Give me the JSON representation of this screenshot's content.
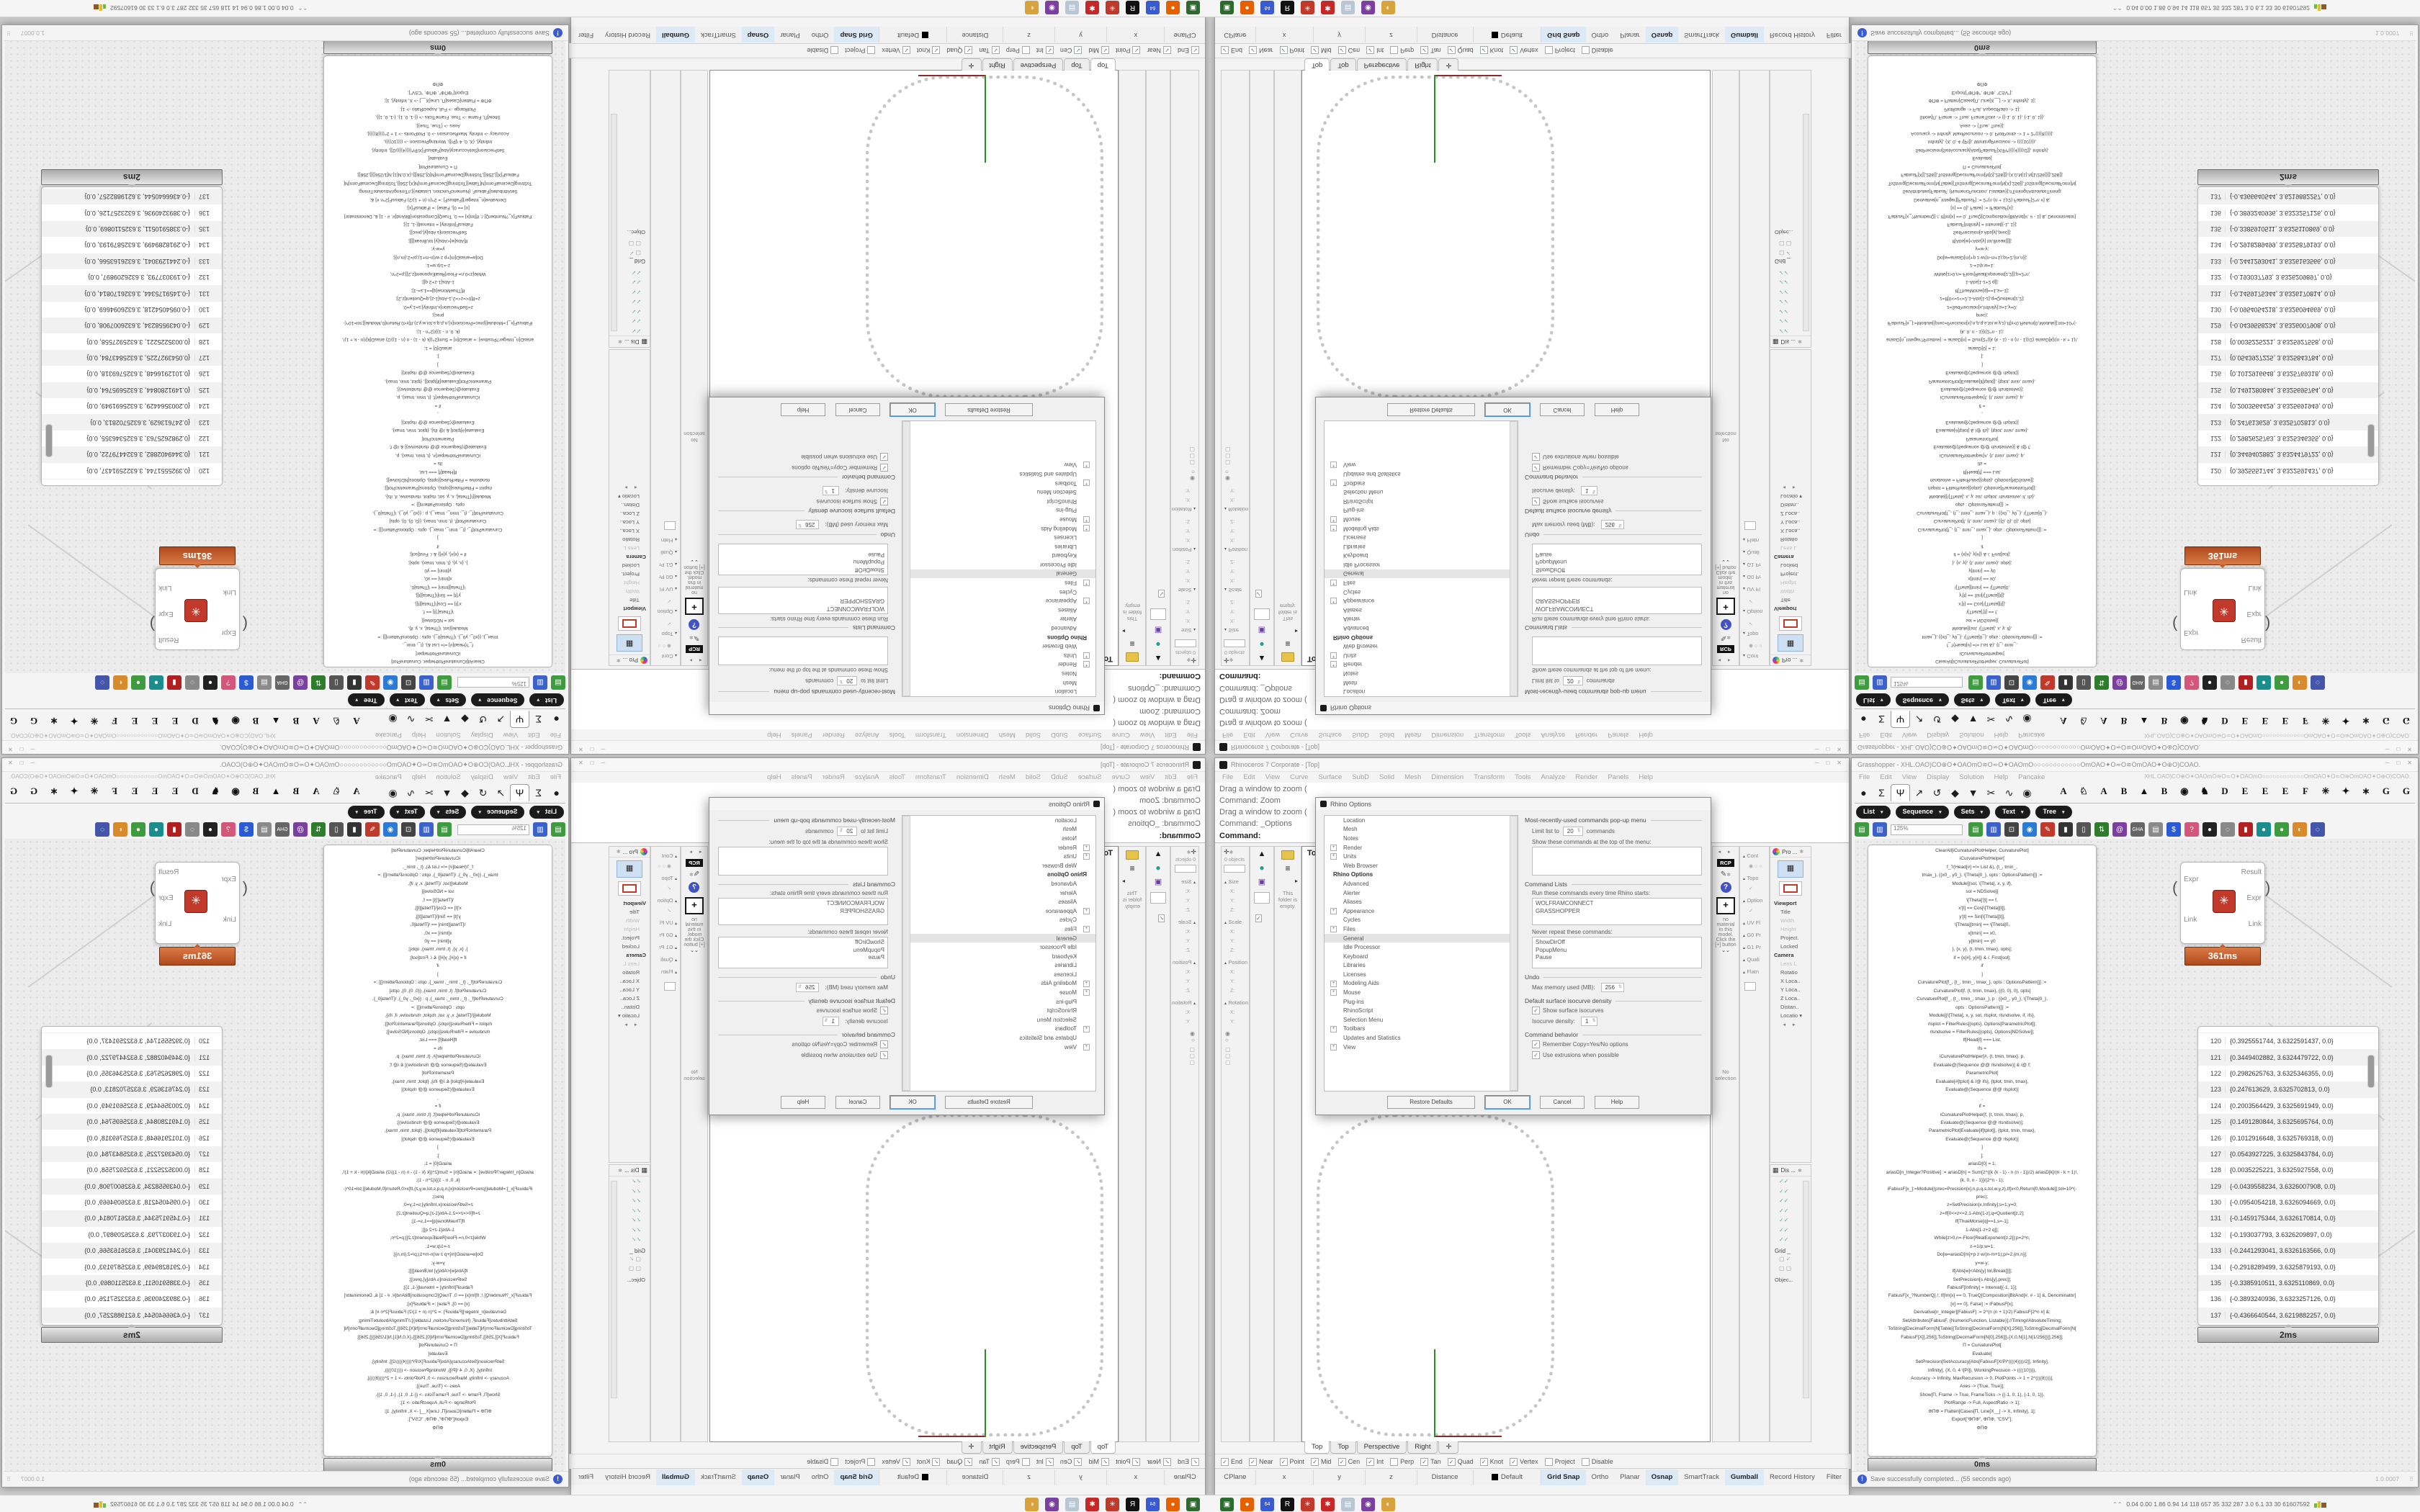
{
  "rhino": {
    "title": "Rhinoceros 7 Corporate - [Top]",
    "window_controls": [
      "─",
      "□",
      "✕"
    ],
    "menu": [
      "File",
      "Edit",
      "View",
      "Curve",
      "Surface",
      "SubD",
      "Solid",
      "Mesh",
      "Dimension",
      "Transform",
      "Tools",
      "Analyze",
      "Render",
      "Panels",
      "Help"
    ],
    "command_history": [
      "Drag a window to zoom (",
      "Command: Zoom",
      "Drag a window to zoom (",
      "Command: _Options"
    ],
    "command_prompt": "Command:",
    "viewport": {
      "label": "Top",
      "tabs": [
        {
          "label": "Top",
          "active": true
        },
        {
          "label": "Top"
        },
        {
          "label": "Perspective"
        },
        {
          "label": "Right"
        },
        {
          "label": "✛"
        }
      ]
    },
    "left_panels": {
      "boxedit_objects": "0 objects",
      "boxedit_groups": [
        {
          "t": "Size"
        },
        {
          "t": "X:",
          "cls": "ax"
        },
        {
          "t": "Y:",
          "cls": "ax"
        },
        {
          "t": "Z:",
          "cls": "ax"
        },
        {
          "t": "Scale"
        },
        {
          "t": "X:",
          "cls": "ax"
        },
        {
          "t": "Y:",
          "cls": "ax"
        },
        {
          "t": "Z:",
          "cls": "ax"
        },
        {
          "t": "Position"
        },
        {
          "t": "X:",
          "cls": "ax"
        },
        {
          "t": "Y:",
          "cls": "ax"
        },
        {
          "t": "Z:",
          "cls": "ax"
        },
        {
          "t": "Rotation"
        },
        {
          "t": "X:",
          "cls": "ax"
        },
        {
          "t": "Y:",
          "cls": "ax"
        }
      ],
      "folder_note": "This folder is empty."
    },
    "right_panels": {
      "materials": {
        "tab": "RCP",
        "plus": "+",
        "empty_text": "no material in this model. Click the [+] button",
        "chevrons": "⌄⌄",
        "selection": "No selection"
      },
      "analysis_labels": [
        {
          "t": "Cont"
        },
        {
          "t": "◉ ○ ○",
          "cls": "ax"
        },
        {
          "t": "Topo"
        },
        {
          "t": "✓",
          "cls": "ax"
        },
        {
          "t": "Option"
        },
        {
          "t": "✓",
          "cls": "ax"
        },
        {
          "t": "UV Fl"
        },
        {
          "t": "G0 Pr"
        },
        {
          "t": "G1 Pr"
        },
        {
          "t": "Quali"
        },
        {
          "t": "Flatn"
        }
      ],
      "properties": {
        "header": "Pro ...",
        "rows": [
          {
            "t": "Viewport",
            "cls": "b"
          },
          {
            "t": "Title"
          },
          {
            "t": "Width",
            "cls": "dim"
          },
          {
            "t": "Height",
            "cls": "dim"
          },
          {
            "t": "Project."
          },
          {
            "t": "Locked"
          },
          {
            "t": "Camera",
            "cls": "b"
          },
          {
            "t": "Lens L",
            "cls": "dim"
          },
          {
            "t": "Rotatio"
          },
          {
            "t": "X Loca.."
          },
          {
            "t": "Y Loca.."
          },
          {
            "t": "Z Loca.."
          },
          {
            "t": "Distan.."
          },
          {
            "t": "Locatio ▾"
          }
        ]
      },
      "display": {
        "header": "Dis ...",
        "grid_label": "Grid _",
        "object_label": "Objec..."
      }
    },
    "osnap": [
      {
        "label": "End",
        "checked": true
      },
      {
        "label": "Near",
        "checked": true
      },
      {
        "label": "Point",
        "checked": true
      },
      {
        "label": "Mid",
        "checked": true
      },
      {
        "label": "Cen",
        "checked": true
      },
      {
        "label": "Int",
        "checked": true
      },
      {
        "label": "Perp",
        "checked": false
      },
      {
        "label": "Tan",
        "checked": true
      },
      {
        "label": "Quad",
        "checked": true
      },
      {
        "label": "Knot",
        "checked": true
      },
      {
        "label": "Vertex",
        "checked": true
      },
      {
        "label": "Project",
        "checked": false
      },
      {
        "label": "Disable",
        "checked": false
      }
    ],
    "status": {
      "cells": [
        "CPlane",
        "x",
        "y",
        "z",
        "Distance"
      ],
      "layer": "Default",
      "toggles": [
        {
          "label": "Grid Snap",
          "active": true
        },
        {
          "label": "Ortho",
          "active": false
        },
        {
          "label": "Planar",
          "active": false
        },
        {
          "label": "Osnap",
          "active": true
        },
        {
          "label": "SmartTrack",
          "active": false
        },
        {
          "label": "Gumball",
          "active": true
        },
        {
          "label": "Record History",
          "active": false
        },
        {
          "label": "Filter",
          "active": false
        }
      ]
    },
    "options_dialog": {
      "title": "Rhino Options",
      "tree": [
        {
          "label": "Location"
        },
        {
          "label": "Mesh"
        },
        {
          "label": "Notes"
        },
        {
          "label": "Render",
          "expand": "+"
        },
        {
          "label": "Units",
          "expand": "+"
        },
        {
          "label": "Web Browser"
        },
        {
          "label": "Rhino Options",
          "header": true
        },
        {
          "label": "Advanced"
        },
        {
          "label": "Alerter"
        },
        {
          "label": "Aliases"
        },
        {
          "label": "Appearance",
          "expand": "+"
        },
        {
          "label": "Cycles"
        },
        {
          "label": "Files",
          "expand": "+"
        },
        {
          "label": "General",
          "selected": true
        },
        {
          "label": "Idle Processor"
        },
        {
          "label": "Keyboard"
        },
        {
          "label": "Libraries"
        },
        {
          "label": "Licenses"
        },
        {
          "label": "Modeling Aids",
          "expand": "+"
        },
        {
          "label": "Mouse",
          "expand": "+"
        },
        {
          "label": "Plug-ins"
        },
        {
          "label": "RhinoScript"
        },
        {
          "label": "Selection Menu"
        },
        {
          "label": "Toolbars",
          "expand": "+"
        },
        {
          "label": "Updates and Statistics"
        },
        {
          "label": "View",
          "expand": "+"
        }
      ],
      "mru_title": "Most-recently-used commands pop-up menu",
      "mru_limit_label": "Limit list to",
      "mru_limit_value": "20",
      "mru_limit_suffix": "commands",
      "mru_show_label": "Show these commands at the top of the menu:",
      "cmdlists_title": "Command Lists",
      "run_label": "Run these commands every time Rhino starts:",
      "run_items": [
        "WOLFRAMCONNECT",
        "GRASSHOPPER"
      ],
      "never_label": "Never repeat these commands:",
      "never_items": [
        "ShowDirOff",
        "PopupMenu",
        "Pause"
      ],
      "undo_title": "Undo",
      "undo_mem_label": "Max memory used (MB):",
      "undo_mem_value": "256",
      "iso_title": "Default surface isocurve density",
      "iso_show": "Show surface isocurves",
      "iso_density_label": "Isocurve density:",
      "iso_density_value": "1",
      "behavior_title": "Command behavior",
      "behavior_opts": [
        {
          "label": "Remember Copy=Yes/No options",
          "checked": true
        },
        {
          "label": "Use extrusions when possible",
          "checked": true
        }
      ],
      "buttons": [
        "Restore Defaults",
        "OK",
        "Cancel",
        "Help"
      ]
    }
  },
  "grasshopper": {
    "title": "Grasshopper - XHL.OAO)CO⊕O✦OAOmO≋O≂O✦OAOmO○○○○○○○○○○○○OmOAO✦O≂O≋OmOAO✦O⊕O)COAO.",
    "window_controls": [
      "─",
      "□",
      "✕"
    ],
    "menu": [
      "File",
      "Edit",
      "View",
      "Display",
      "Solution",
      "Help",
      "Pancake"
    ],
    "menu_right_doc": "XHL.OAO)CO⊕O✦OAOmO≋O≂O✦OAOmO○○○○○○○○○○○○OmOAO✦O≂O≋OmOAO✦O⊕O)COAO.",
    "category_tabs": [
      {
        "g": "●"
      },
      {
        "g": "Σ"
      },
      {
        "g": "Ψ",
        "active": true
      },
      {
        "g": "↗"
      },
      {
        "g": "↺"
      },
      {
        "g": "◆"
      },
      {
        "g": "▼"
      },
      {
        "g": "✂"
      },
      {
        "g": "∿"
      },
      {
        "g": "◉"
      }
    ],
    "letter_tabs": [
      "A",
      "♘",
      "A",
      "B",
      "▲",
      "B",
      "◉",
      "♞",
      "D",
      "E",
      "E",
      "E",
      "F",
      "✳",
      "✦",
      "∗",
      "G",
      "G"
    ],
    "group_pills": [
      "List",
      "Sequence",
      "Sets",
      "Text",
      "Tree"
    ],
    "toolbar": {
      "zoom_value": "125%",
      "icons": [
        {
          "name": "open-file-icon",
          "g": "▤",
          "c": "#3f9b3f"
        },
        {
          "name": "save-file-icon",
          "g": "▥",
          "c": "#3b62c9"
        },
        {
          "name": "zoom-extents-icon",
          "g": "⊡",
          "c": "#444"
        },
        {
          "name": "preview-eye-icon",
          "g": "◉",
          "c": "#2b7bd4"
        },
        {
          "name": "sketch-pencil-icon",
          "g": "✎",
          "c": "#c0392b"
        },
        {
          "name": "camera-icon",
          "g": "▮",
          "c": "#333"
        },
        {
          "name": "speaker-icon",
          "g": "▯",
          "c": "#555"
        },
        {
          "name": "axes-tree-icon",
          "g": "⇅",
          "c": "#2d7d2d"
        },
        {
          "name": "cluster-at-icon",
          "g": "@",
          "c": "#7b3fa0"
        },
        {
          "name": "gha-installer-icon",
          "g": "GHA",
          "c": "#666"
        },
        {
          "name": "notes-icon",
          "g": "▤",
          "c": "#8a8a8a"
        },
        {
          "name": "finder-icon",
          "g": "$",
          "c": "#2b5bd4"
        },
        {
          "name": "help-box-icon",
          "g": "?",
          "c": "#d4577b"
        },
        {
          "name": "bake-dark-icon",
          "g": "●",
          "c": "#222"
        },
        {
          "name": "bake-light-icon",
          "g": "◌",
          "c": "#888"
        },
        {
          "name": "red-cylinder-icon",
          "g": "▮",
          "c": "#b02020"
        },
        {
          "name": "teal-ball-icon",
          "g": "●",
          "c": "#1b8d8d"
        },
        {
          "name": "green-ball-icon",
          "g": "●",
          "c": "#3f9b3f"
        },
        {
          "name": "orange-ball-icon",
          "g": "◐",
          "c": "#d98a2b"
        },
        {
          "name": "lasso-select-icon",
          "g": "◌",
          "c": "#4455aa"
        }
      ]
    },
    "canvas": {
      "code_lines": [
        "ClearAll[iCurvaturePlotHelper, CurvaturePlot]",
        "iCurvaturePlotHelper[",
        "f_?(Head[#] =!= List &), {t_, tmin_,",
        "tmax_}, {{x0_, y0_}, \\[Theta]0_}, opts : OptionsPattern[]] :=",
        "Module[{sol, \\[Theta], x, y, if},",
        "sol = NDSolve[{",
        "\\[Theta]'[t] == f,",
        "x'[t] == Cos[\\[Theta][t]],",
        "y'[t] == Sin[\\[Theta][t]],",
        "\\[Theta][tmin] == \\[Theta]0,",
        "x[tmin] == x0,",
        "y[tmin] == y0",
        "}, {x, y}, {t, tmin, tmax}, opts];",
        "if = {x[#], y[#]} & /. First[sol];",
        "if",
        "]",
        "CurvaturePlot[f_, {t_, tmin_, tmax_}, opts : OptionsPattern[]] :=",
        "CurvaturePlot[f, {t, tmin, tmax}, {{0, 0}, 0}, opts]",
        "CurvaturePlot[f_, {t_, tmin_, tmax_}, p : {{x0_, y0_}, \\[Theta]0_},",
        "opts : OptionsPattern[]] :=",
        "Module[{\\[Theta], x, y, sol, rlsplot, rlsndsolve, if, ifs},",
        "rlsplot = FilterRules[{opts}, Options[ParametricPlot]];",
        "rlsndsolve = FilterRules[{opts}, Options[NDSolve]];",
        "If[Head[f] === List,",
        "ifs =",
        "iCurvaturePlotHelper[#, {t, tmin, tmax}, p,",
        "Evaluate@(Sequence @@ rlsndsolve)] & /@ f;",
        "ParametricPlot[",
        "Evaluate[#[tplot] & /@ ifs], {tplot, tmin, tmax},",
        "Evaluate@(Sequence @@ rlsplot)]",
        ",",
        "if =",
        "iCurvaturePlotHelper[f, {t, tmin, tmax}, p,",
        "Evaluate@(Sequence @@ rlsndsolve)];",
        "ParametricPlot[Evaluate[if[tplot]], {tplot, tmin, tmax},",
        "Evaluate@(Sequence @@ rlsplot)]",
        "]",
        "];",
        "",
        "ariasD[0] = 1;",
        "ariasD[n_Integer?Positive] := ariasD[n] = Sum[2^((k (k - 1) - n (n - 1))/2) ariasD[k]/(n - k + 1)!,",
        "{k, 0, n - 1}]/(2^n - 1);",
        "iFabiusF[x_]:=Module[{prec=Precision[x],n,p,q,s,tol,w,y,z},If[x<0,Return[0,Module]];tol=10^(-",
        "prec);",
        "z=SetPrecision[x,Infinity];s=1;y=0;",
        "z=If[0<=z<=2,1-Abs[1-z],q=Quotient[z,2];",
        "If[ThueMorse[q]==1,s=-1];",
        "1-Abs[1-z+2 q]];",
        "While[z>0,n=-Floor[RealExponent[z,2]];p=2^n;",
        "z-=1/p;w=1;",
        "Do[w=ariasD[m]+p z w/(n-m+1);p/=2,{m,n}];",
        "y=w-y;",
        "If[Abs[w]<Abs[y] tol,Break[]]];",
        "SetPrecision[s Abs[y],prec]];",
        "FabiusF[Infinity] = Interval[{-1, 1}];",
        "FabiusF[x_?NumberQ] /; If[Im[x] == 0, TrueQ[Composition[BitAnd[#, # - 1] &, Denominator]",
        "[x] == 0], False] := iFabiusF[x];",
        "Derivative[n_Integer][FabiusF] := 2^(n (n + 1)/2) FabiusF[2^n #] &;",
        "SetAttributes[FabiusF, {NumericFunction, Listable}];//Timing//AbsoluteTiming;",
        "",
        "ToString[DecimalForm[N[Table[{ToString[DecimalForm[N[X],256]],ToString[DecimalForm[N[",
        "FabiusF[X]],256]],ToString[DecimalForm[N[0],256]]},{X,0,N[1],N[1/256]}]],256]];",
        "",
        "Π = CurvaturePlot[",
        "Evaluate[",
        "SetPrecision[SetAccuracy[Abs[FabiusF[X/Pi*((((4))))/2]], Infinity],",
        "Infinity], {X, 0, 4 \\[Pi]}, WorkingPrecision -> ((((10)))),",
        "Accuracy -> Infinity, MaxRecursion -> 0, PlotPoints -> 1 + 2^((((8))))],",
        "Axes -> {True, True}];",
        "Show[Π, Frame -> True, FrameTicks -> {{-1, 0, 1}, {-1, 0, 1}},",
        "PlotRange -> Full, AspectRatio -> 1];",
        "ΦΠΦ = Flatten[Cases[Π, Line[X__] -> X, Infinity], 1];",
        "Export[\"ΦΠΦ\", ΦΠΦ, \"CSV\"];",
        "ΦΠΦ"
      ],
      "code_badge": "0ms",
      "component": {
        "inputs": [
          "Expr",
          "Link"
        ],
        "outputs": [
          "Result",
          "Expr",
          "Link"
        ],
        "badge": "361ms",
        "icon_glyph": "✳"
      },
      "list": {
        "badge": "2ms",
        "rows": [
          {
            "i": "120",
            "v": "{0.3925551744, 3.6322591437, 0.0}"
          },
          {
            "i": "121",
            "v": "{0.3449402882, 3.6324479722, 0.0}"
          },
          {
            "i": "122",
            "v": "{0.2982625763, 3.6325346355, 0.0}"
          },
          {
            "i": "123",
            "v": "{0.247613629, 3.6325702813, 0.0}"
          },
          {
            "i": "124",
            "v": "{0.2003564429, 3.6325691949, 0.0}"
          },
          {
            "i": "125",
            "v": "{0.1491280844, 3.6325695764, 0.0}"
          },
          {
            "i": "126",
            "v": "{0.1012916648, 3.6325769318, 0.0}"
          },
          {
            "i": "127",
            "v": "{0.0543927225, 3.6325843784, 0.0}"
          },
          {
            "i": "128",
            "v": "{0.0035225221, 3.6325927558, 0.0}"
          },
          {
            "i": "129",
            "v": "{-0.0439558234, 3.6326007908, 0.0}"
          },
          {
            "i": "130",
            "v": "{-0.0954054218, 3.6326094669, 0.0}"
          },
          {
            "i": "131",
            "v": "{-0.1459175344, 3.6326170814, 0.0}"
          },
          {
            "i": "132",
            "v": "{-0.193037793, 3.6326209897, 0.0}"
          },
          {
            "i": "133",
            "v": "{-0.2441293041, 3.6326163566, 0.0}"
          },
          {
            "i": "134",
            "v": "{-0.2918289499, 3.6325879193, 0.0}"
          },
          {
            "i": "135",
            "v": "{-0.3385910511, 3.6325110869, 0.0}"
          },
          {
            "i": "136",
            "v": "{-0.3893240936, 3.6323257126, 0.0}"
          },
          {
            "i": "137",
            "v": "{-0.4366640544, 3.6219882257, 0.0}"
          }
        ]
      }
    },
    "status": {
      "message": "Save successfully completed... (55 seconds ago)",
      "version": "1.0.0007"
    }
  },
  "taskbar": {
    "icons": [
      {
        "name": "terminal-app-icon",
        "g": "▣",
        "c": "#2d6a2d"
      },
      {
        "name": "firefox-icon",
        "g": "●",
        "c": "#e66000"
      },
      {
        "name": "hwinfo64-icon",
        "g": "64",
        "c": "#3a5bd0"
      },
      {
        "name": "rhino-app-icon",
        "g": "R",
        "c": "#111111"
      },
      {
        "name": "mathematica-icon",
        "g": "✳",
        "c": "#c0392b"
      },
      {
        "name": "red-gear-app-icon",
        "g": "✱",
        "c": "#c62828"
      },
      {
        "name": "notepad-icon",
        "g": "▤",
        "c": "#b9c6d6"
      },
      {
        "name": "owl-app-icon",
        "g": "◉",
        "c": "#7b3fa0"
      },
      {
        "name": "palette-app-icon",
        "g": "◐",
        "c": "#d9a33c"
      }
    ],
    "tray_stats": "0.04 0.00 1.86 0.94   14   118   657   35   332   287   3.0   6.1   33   30   61607592"
  }
}
